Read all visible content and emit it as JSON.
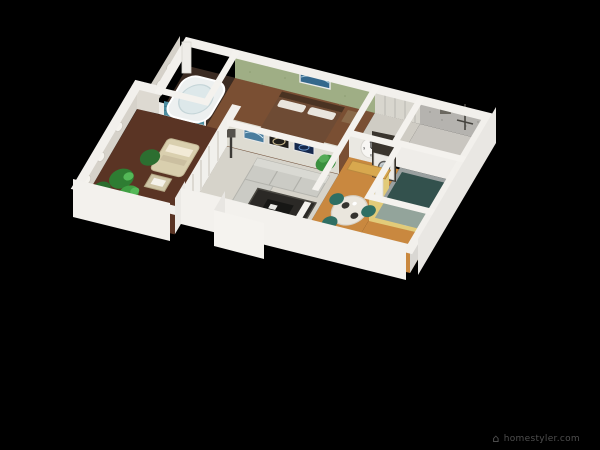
{
  "scene": {
    "type": "3d-floorplan-dollhouse-render",
    "background_color": "#000000"
  },
  "watermark": {
    "icon": "homestyler-logo-icon",
    "glyph": "⌂",
    "text": "homestyler.com",
    "text_color": "#4f4f4f"
  },
  "floorplan": {
    "wall_color": "#f2f0ec",
    "clock": {
      "name": "wall-clock",
      "face_color": "#f7f6f3",
      "dial_numbers": [
        "12",
        "3",
        "6",
        "9"
      ]
    },
    "rooms": [
      {
        "name": "balcony-garden",
        "floor_color": "#5a3424",
        "furniture": [
          "potted-plants",
          "lounge-chair",
          "towels",
          "side-table",
          "oval-wall-lights"
        ]
      },
      {
        "name": "bathroom",
        "floor_color": "#3b2b22",
        "furniture": [
          "corner-jacuzzi-tub",
          "blue-mosaic-tub-panel"
        ]
      },
      {
        "name": "bedroom-green",
        "wall_color": "#9fae85",
        "floor_color": "#7a4f33",
        "furniture": [
          "double-bed",
          "white-pillows",
          "ocean-wall-art"
        ]
      },
      {
        "name": "walk-in-closet",
        "floor_color": "#cfccc4",
        "furniture": [
          "wardrobe-partitions"
        ]
      },
      {
        "name": "laundry-bathroom",
        "wall_color": "#b5b3af",
        "floor_color": "#c9c6c0",
        "furniture": [
          "wall-drying-rack",
          "wall-shelves"
        ]
      },
      {
        "name": "bedroom-teal",
        "floor_color": "#9aa0a0",
        "furniture": [
          "teal-bed"
        ]
      },
      {
        "name": "hallway",
        "floor_color": "#c9883f",
        "furniture": [
          "wall-clock",
          "storage-bench",
          "washing-machine"
        ]
      },
      {
        "name": "living-room",
        "wall_color": "#dedcd2",
        "floor_color": "#d6d3ca",
        "furniture": [
          "sectional-sofa",
          "area-rug",
          "coffee-table",
          "floor-lamp",
          "potted-plant",
          "wave-wall-art",
          "swirl-wall-art",
          "galaxy-wall-art",
          "white-curtains"
        ]
      },
      {
        "name": "dining-room",
        "wall_color": "#e2cb79",
        "floor_color": "#c9883f",
        "furniture": [
          "round-dining-table",
          "teal-dining-chairs",
          "place-settings",
          "light-switch",
          "door-frame"
        ]
      }
    ]
  }
}
